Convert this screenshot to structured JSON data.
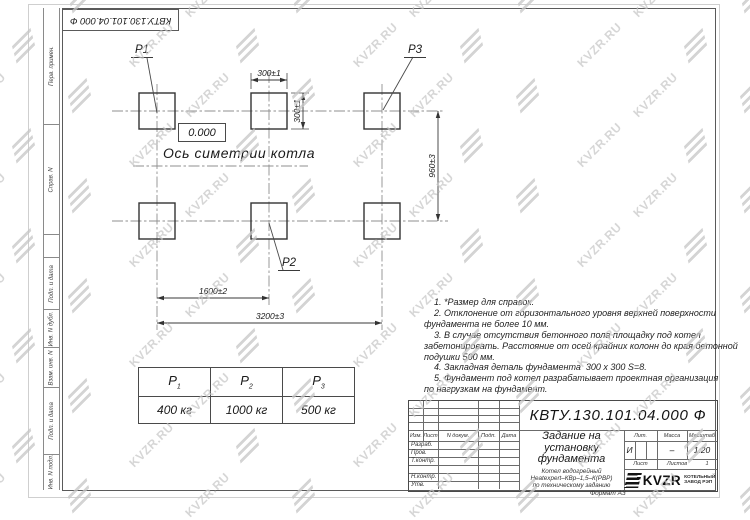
{
  "watermark": {
    "text": "KVZR.RU"
  },
  "stamp_top": {
    "doc_number_rotated": "КВТУ.130.101.04.000  Ф"
  },
  "side_strip": {
    "labels": [
      "Перв. примен.",
      "Справ. N",
      "Подп. и дата",
      "Инв. N дубл.",
      "Взам. инв. N",
      "Подп. и дата",
      "Инв. N подл."
    ]
  },
  "drawing": {
    "point_labels": {
      "p1": "P1",
      "p2": "P2",
      "p3": "P3"
    },
    "level_mark": "0.000",
    "axis_label": "Ось симетрии котла",
    "dims": {
      "pad_width": "300±1",
      "pad_height": "300±1",
      "row_spacing": "960±3",
      "half_span": "1600±2",
      "full_span": "3200±3"
    }
  },
  "notes": {
    "lines": [
      "    1. *Размер для справок.",
      "    2. Отклонение от горизонтального уровня верхней поверхности",
      "фундамента не более 10 мм.",
      "    3. В случае отсутствия бетонного пола площадку под котел",
      "забетонировать. Расстояние от осей крайних колонн до края бетонной",
      "подушки 500 мм.",
      "    4. Закладная деталь фундамента  300 х 300 S=8.",
      "    5. Фундамент под котел разрабатывает проектная организация",
      "по нагрузкам на фундамент."
    ]
  },
  "load_table": {
    "headers": [
      {
        "base": "P",
        "sub": "1"
      },
      {
        "base": "P",
        "sub": "2"
      },
      {
        "base": "P",
        "sub": "3"
      }
    ],
    "values": [
      "400 кг",
      "1000 кг",
      "500 кг"
    ]
  },
  "title_block": {
    "doc_number": "КВТУ.130.101.04.000  Ф",
    "title_lines": [
      "Задание на",
      "установку",
      "фундамента"
    ],
    "subtitle_lines": [
      "Котел водогрейный",
      "Heatexpert–КВр–1,5–К(РВР)",
      "по техническому заданию"
    ],
    "header_cols": [
      "Изм.",
      "Лист",
      "N докум.",
      "Подп.",
      "Дата"
    ],
    "row_labels": [
      "Разраб.",
      "Пров.",
      "Т.контр.",
      "",
      "Н.контр.",
      "Утв."
    ],
    "lit_label": "Лит.",
    "lit_value": "И",
    "mass_label": "Масса",
    "mass_value": "–",
    "scale_label": "Масштаб",
    "scale_value": "1:20",
    "sheet_label": "Лист",
    "sheets_label": "Листов",
    "sheets_value": "1",
    "company": {
      "name": "KVZR",
      "line1": "КОТЕЛЬНЫЙ",
      "line2": "ЗАВОД РЭП"
    },
    "format_label": "Формат А3"
  }
}
